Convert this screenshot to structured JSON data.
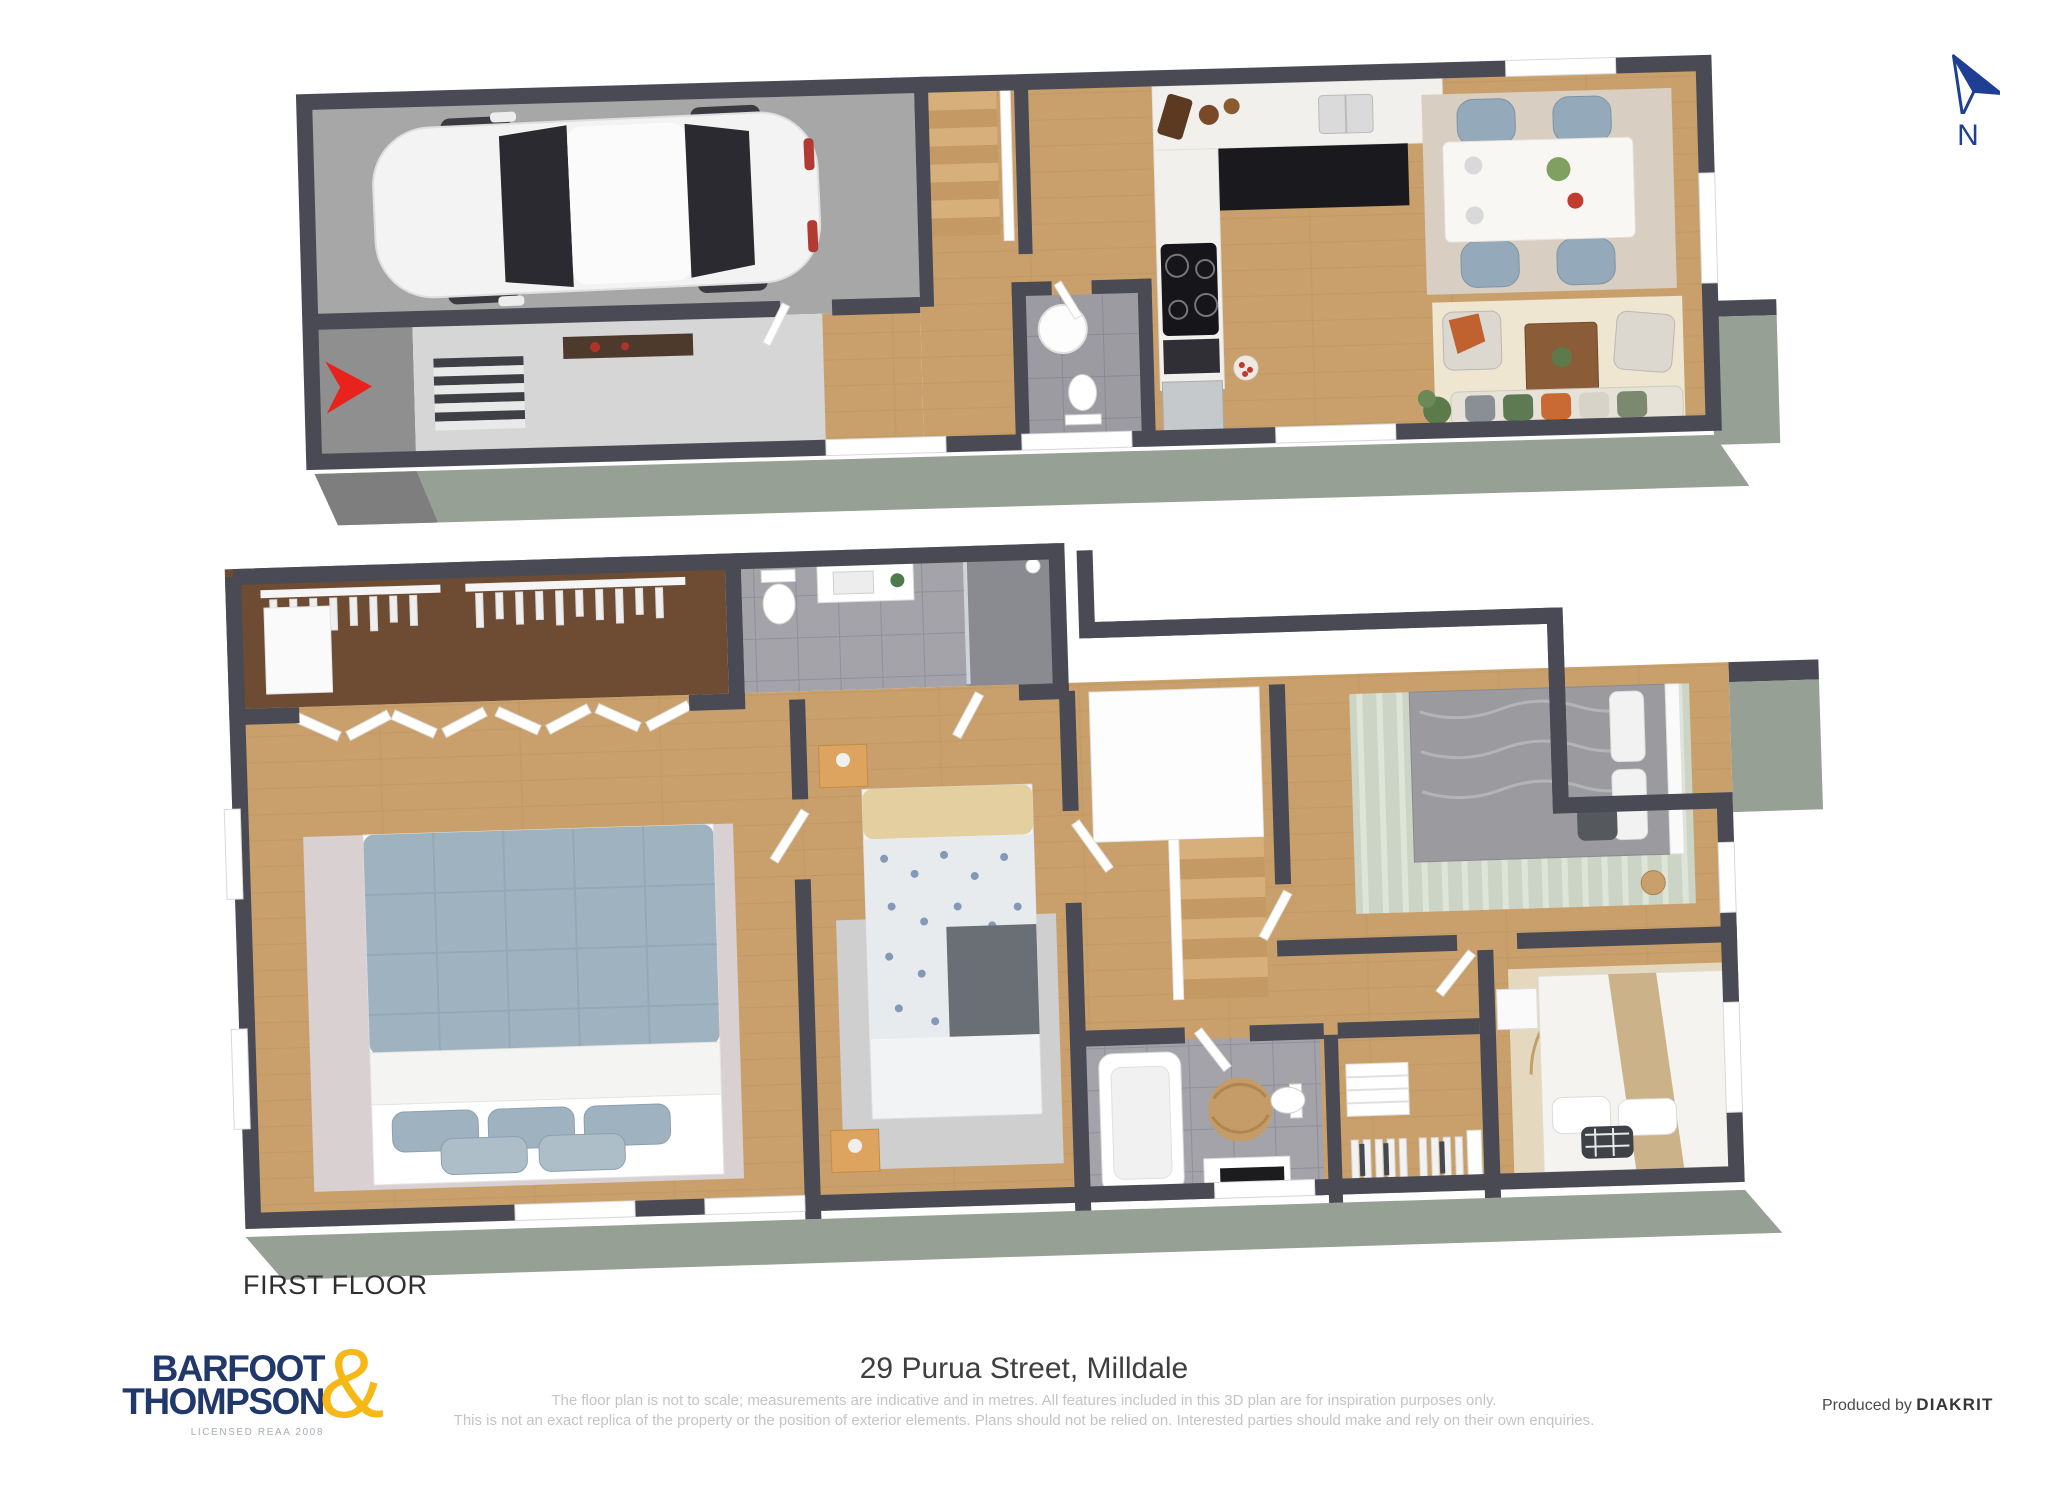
{
  "compass": {
    "label": "N",
    "color": "#1E3F93"
  },
  "floors": [
    {
      "label": "GROUND FLOOR",
      "rooms": [
        "garage",
        "entry-porch",
        "entry-hall",
        "staircase",
        "powder-room",
        "kitchen",
        "dining-area",
        "living-area",
        "deck"
      ]
    },
    {
      "label": "FIRST FLOOR",
      "rooms": [
        "walk-in-wardrobe",
        "ensuite-bathroom",
        "master-bedroom",
        "bedroom-2",
        "stair-landing",
        "bedroom-3",
        "bedroom-4",
        "main-bathroom",
        "closet"
      ]
    }
  ],
  "footer": {
    "logo": {
      "line1": "BARFOOT",
      "line2": "THOMPSON",
      "amp": "&",
      "sub": "LICENSED REAA 2008",
      "navy": "#21386B",
      "gold": "#F5B817"
    },
    "address": "29 Purua Street, Milldale",
    "disclaimer1": "The floor plan is not to scale; measurements are indicative and in metres. All features included in this 3D plan are for inspiration purposes only.",
    "disclaimer2": "This is not an exact replica of the property or the position of exterior elements. Plans should not be relied on. Interested parties should make and rely on their own enquiries.",
    "produced_by": "Produced by",
    "producer": "DIAKRIT"
  },
  "colors": {
    "wall": "#4A4A54",
    "wood_floor": "#C9A06B",
    "garage_concrete": "#A7A7A7",
    "tile": "#9B9BA1",
    "exterior_sage": "#96A094",
    "entry_arrow_red": "#E8231D",
    "dining_chair_blue": "#94AABA",
    "bed_blue": "#9FB2C0",
    "kitchen_cabinet_black": "#1A1A1E"
  }
}
